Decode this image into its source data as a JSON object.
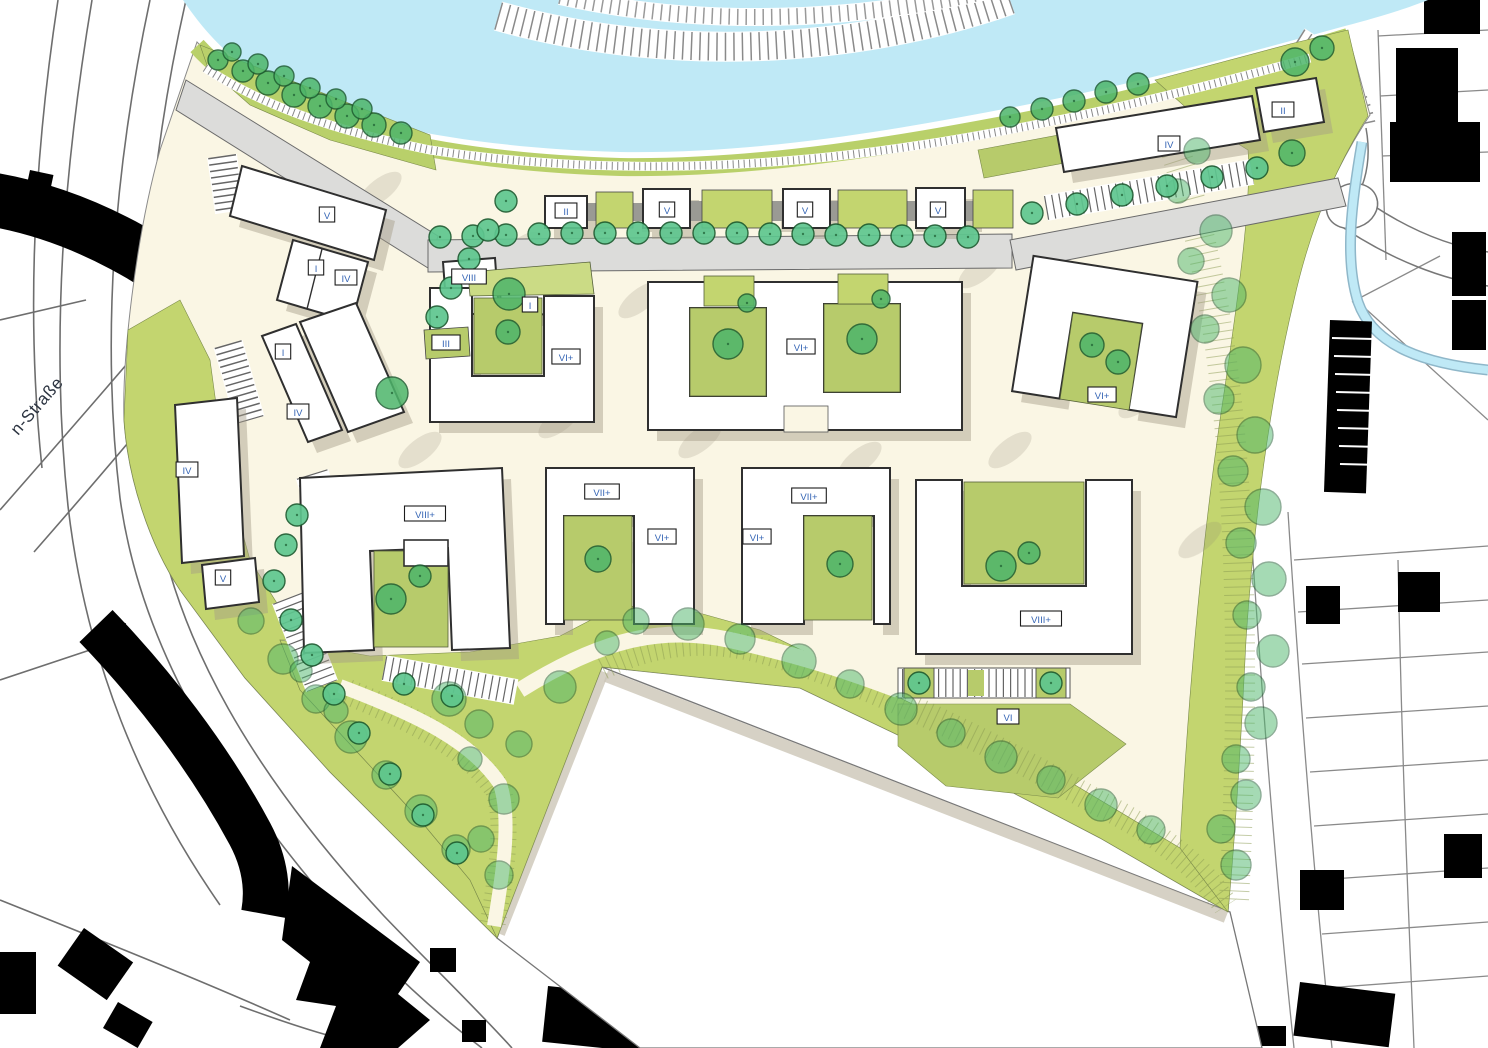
{
  "map": {
    "street_label": "n-Straße",
    "palette": {
      "water": "#bfe9f6",
      "ground": "#faf6e4",
      "green_band": "#c3d56f",
      "bank_green": "#b9d06a",
      "lawn": "#b7cb6b",
      "lawn_light": "#cbdb85",
      "road": "#dcdcda",
      "building_fill": "#ffffff",
      "building_outline": "#2f2f2f",
      "context_black": "#000000",
      "tree_street": "#5ec68f",
      "tree_park": "#4db56a",
      "tree_outline": "#1d5c31",
      "label_text": "#3565b5",
      "shadow": "#a39b87"
    },
    "building_labels": [
      {
        "text": "V",
        "x": 327,
        "y": 215
      },
      {
        "text": "I",
        "x": 316,
        "y": 268
      },
      {
        "text": "IV",
        "x": 346,
        "y": 278
      },
      {
        "text": "II",
        "x": 566,
        "y": 211
      },
      {
        "text": "V",
        "x": 667,
        "y": 210
      },
      {
        "text": "V",
        "x": 805,
        "y": 210
      },
      {
        "text": "V",
        "x": 938,
        "y": 210
      },
      {
        "text": "VIII",
        "x": 469,
        "y": 277
      },
      {
        "text": "I",
        "x": 530,
        "y": 305
      },
      {
        "text": "III",
        "x": 446,
        "y": 343
      },
      {
        "text": "VI+",
        "x": 566,
        "y": 357
      },
      {
        "text": "VI+",
        "x": 801,
        "y": 347
      },
      {
        "text": "VI+",
        "x": 1102,
        "y": 395
      },
      {
        "text": "IV",
        "x": 1169,
        "y": 144
      },
      {
        "text": "II",
        "x": 1283,
        "y": 110
      },
      {
        "text": "I",
        "x": 283,
        "y": 352
      },
      {
        "text": "IV",
        "x": 298,
        "y": 412
      },
      {
        "text": "IV",
        "x": 187,
        "y": 470
      },
      {
        "text": "V",
        "x": 223,
        "y": 578
      },
      {
        "text": "VIII+",
        "x": 425,
        "y": 514
      },
      {
        "text": "VII+",
        "x": 602,
        "y": 492
      },
      {
        "text": "VI+",
        "x": 662,
        "y": 537
      },
      {
        "text": "VII+",
        "x": 809,
        "y": 496
      },
      {
        "text": "VI+",
        "x": 757,
        "y": 537
      },
      {
        "text": "VIII+",
        "x": 1041,
        "y": 619
      },
      {
        "text": "VI",
        "x": 1008,
        "y": 717
      }
    ],
    "trees": {
      "street": [
        [
          440,
          237
        ],
        [
          473,
          236
        ],
        [
          506,
          235
        ],
        [
          539,
          234
        ],
        [
          572,
          233
        ],
        [
          605,
          233
        ],
        [
          638,
          233
        ],
        [
          671,
          233
        ],
        [
          704,
          233
        ],
        [
          737,
          233
        ],
        [
          770,
          234
        ],
        [
          803,
          234
        ],
        [
          836,
          235
        ],
        [
          869,
          235
        ],
        [
          902,
          236
        ],
        [
          935,
          236
        ],
        [
          968,
          237
        ],
        [
          506,
          201
        ],
        [
          488,
          230
        ],
        [
          469,
          259
        ],
        [
          451,
          288
        ],
        [
          437,
          317
        ],
        [
          297,
          515
        ],
        [
          286,
          545
        ],
        [
          274,
          581
        ],
        [
          291,
          620
        ],
        [
          312,
          655
        ],
        [
          334,
          694
        ],
        [
          359,
          733
        ],
        [
          390,
          774
        ],
        [
          423,
          815
        ],
        [
          457,
          853
        ],
        [
          1032,
          213
        ],
        [
          1077,
          204
        ],
        [
          1122,
          195
        ],
        [
          1167,
          186
        ],
        [
          1212,
          177
        ],
        [
          1257,
          168
        ],
        [
          919,
          683
        ],
        [
          1051,
          683
        ],
        [
          404,
          684
        ],
        [
          452,
          696
        ]
      ],
      "park": [
        [
          218,
          60,
          10
        ],
        [
          243,
          71,
          11
        ],
        [
          268,
          83,
          12
        ],
        [
          294,
          95,
          12
        ],
        [
          320,
          106,
          12
        ],
        [
          347,
          116,
          12
        ],
        [
          374,
          125,
          12
        ],
        [
          401,
          133,
          11
        ],
        [
          232,
          52,
          9
        ],
        [
          258,
          64,
          10
        ],
        [
          284,
          76,
          10
        ],
        [
          310,
          88,
          10
        ],
        [
          336,
          99,
          10
        ],
        [
          362,
          109,
          10
        ],
        [
          1010,
          117,
          10
        ],
        [
          1042,
          109,
          11
        ],
        [
          1074,
          101,
          11
        ],
        [
          1106,
          92,
          11
        ],
        [
          1138,
          84,
          11
        ],
        [
          1295,
          62,
          14
        ],
        [
          1322,
          48,
          12
        ],
        [
          509,
          294,
          16
        ],
        [
          508,
          332,
          12
        ],
        [
          728,
          344,
          15
        ],
        [
          862,
          339,
          15
        ],
        [
          747,
          303,
          9
        ],
        [
          881,
          299,
          9
        ],
        [
          598,
          559,
          13
        ],
        [
          840,
          564,
          13
        ],
        [
          391,
          599,
          15
        ],
        [
          420,
          576,
          11
        ],
        [
          1001,
          566,
          15
        ],
        [
          1029,
          553,
          11
        ],
        [
          1092,
          345,
          12
        ],
        [
          1118,
          362,
          12
        ],
        [
          392,
          393,
          16
        ],
        [
          1292,
          153,
          13
        ]
      ],
      "canopy": [
        [
          1197,
          151,
          13
        ],
        [
          1178,
          191,
          12
        ],
        [
          1216,
          231,
          16
        ],
        [
          1191,
          261,
          13
        ],
        [
          1229,
          295,
          17
        ],
        [
          1205,
          329,
          14
        ],
        [
          1243,
          365,
          18
        ],
        [
          1219,
          399,
          15
        ],
        [
          1255,
          435,
          18
        ],
        [
          1233,
          471,
          15
        ],
        [
          1263,
          507,
          18
        ],
        [
          1241,
          543,
          15
        ],
        [
          1269,
          579,
          17
        ],
        [
          1247,
          615,
          14
        ],
        [
          1273,
          651,
          16
        ],
        [
          1251,
          687,
          14
        ],
        [
          1261,
          723,
          16
        ],
        [
          1236,
          759,
          14
        ],
        [
          1246,
          795,
          15
        ],
        [
          1221,
          829,
          14
        ],
        [
          1236,
          865,
          15
        ],
        [
          636,
          621,
          13
        ],
        [
          688,
          624,
          16
        ],
        [
          740,
          639,
          15
        ],
        [
          799,
          661,
          17
        ],
        [
          850,
          684,
          14
        ],
        [
          901,
          709,
          16
        ],
        [
          951,
          733,
          14
        ],
        [
          1001,
          757,
          16
        ],
        [
          1051,
          780,
          14
        ],
        [
          1101,
          805,
          16
        ],
        [
          1151,
          830,
          14
        ],
        [
          560,
          687,
          16
        ],
        [
          607,
          643,
          12
        ],
        [
          449,
          699,
          17
        ],
        [
          479,
          724,
          14
        ],
        [
          519,
          744,
          13
        ],
        [
          470,
          759,
          12
        ],
        [
          504,
          799,
          15
        ],
        [
          481,
          839,
          13
        ],
        [
          499,
          875,
          14
        ],
        [
          251,
          621,
          13
        ],
        [
          283,
          659,
          15
        ],
        [
          316,
          699,
          14
        ],
        [
          351,
          737,
          16
        ],
        [
          386,
          775,
          14
        ],
        [
          421,
          811,
          16
        ],
        [
          456,
          849,
          14
        ],
        [
          301,
          671,
          11
        ],
        [
          336,
          711,
          12
        ]
      ]
    }
  }
}
